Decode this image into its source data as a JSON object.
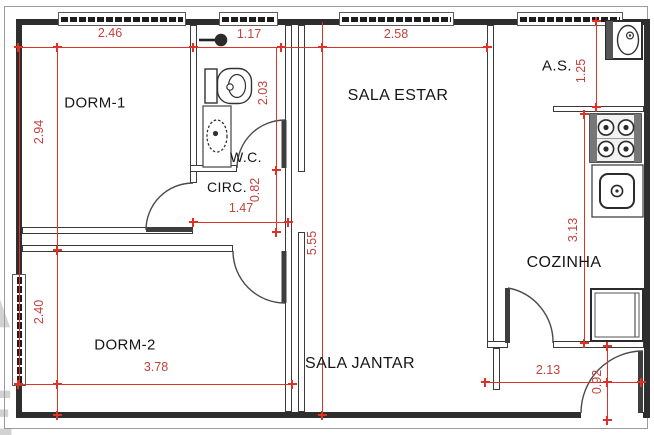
{
  "rooms": {
    "dorm1": "DORM-1",
    "dorm2": "DORM-2",
    "wc": "W.C.",
    "circ": "CIRC.",
    "sala_estar": "SALA ESTAR",
    "sala_jantar": "SALA JANTAR",
    "as": "A.S.",
    "cozinha": "COZINHA"
  },
  "dims": {
    "dorm1_width": "2.46",
    "wc_width": "1.17",
    "sala_estar_width": "2.58",
    "dorm1_height": "2.94",
    "wc_height": "2.03",
    "circ_height": "0.82",
    "circ_width": "1.47",
    "sala_total_height": "5.55",
    "as_height": "1.25",
    "cozinha_height": "3.13",
    "dorm2_height": "2.40",
    "dorm2_width": "3.78",
    "cozinha_width": "2.13",
    "entry_depth": "0.92"
  },
  "watermark": {
    "letters": [
      "A",
      "E"
    ]
  },
  "fixtures": [
    "shower",
    "toilet",
    "washbasin",
    "laundry-tank",
    "stove",
    "kitchen-sink",
    "refrigerator"
  ],
  "colors": {
    "dimension_red": "#dd3327",
    "wall_dark": "#2e2e2e",
    "frame_gray": "#9b9b9b"
  }
}
